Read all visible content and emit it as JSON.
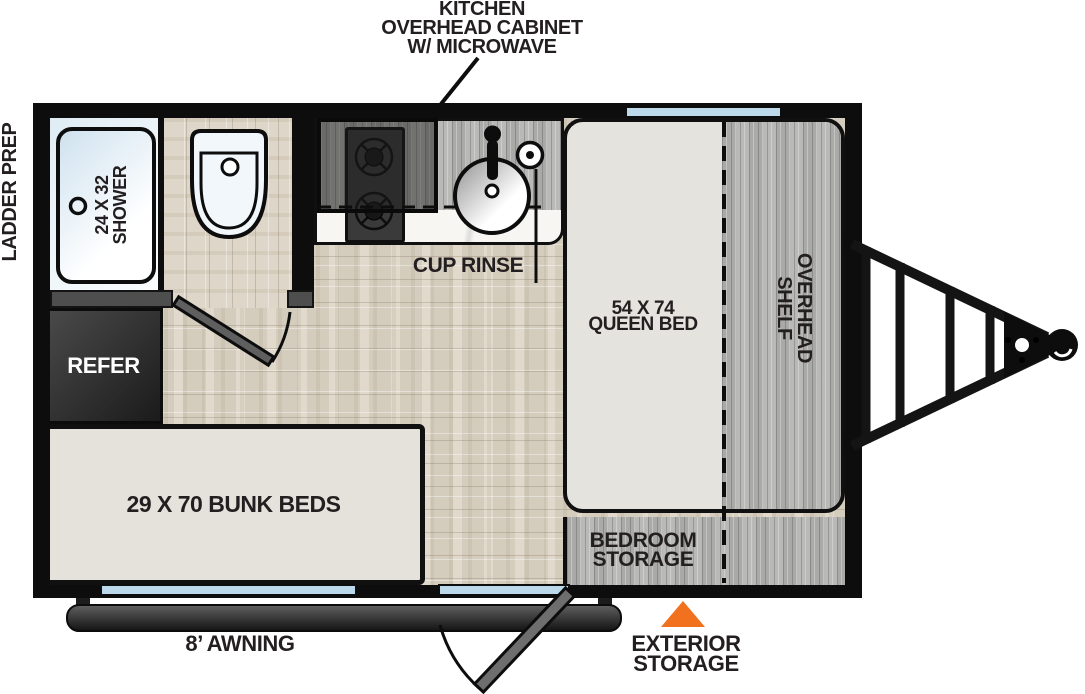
{
  "diagram": {
    "type": "travel-trailer-floorplan"
  },
  "labels": {
    "kitchen_overhead_cabinet": "KITCHEN\nOVERHEAD CABINET\nW/ MICROWAVE",
    "ladder_prep": "LADDER PREP",
    "shower": "24 X 32\nSHOWER",
    "cup_rinse": "CUP RINSE",
    "refer": "REFER",
    "queen_bed": "54 X 74\nQUEEN BED",
    "overhead_shelf": "OVERHEAD\nSHELF",
    "bunk_beds": "29 X 70 BUNK BEDS",
    "bedroom_storage": "BEDROOM\nSTORAGE",
    "awning": "8’ AWNING",
    "exterior_storage": "EXTERIOR\nSTORAGE"
  },
  "colors": {
    "wall_black": "#0D0D0D",
    "wood_floor": "#DDD5C6",
    "gray_wood": "#B4B4B2",
    "mattress": "#E5E3DD",
    "window_blue": "#BCD9EC",
    "shower_blue": "#DFECF4",
    "refrigerator_dark": "#2E2E2E",
    "accent_orange": "#F2711F",
    "label_text": "#231F20"
  }
}
